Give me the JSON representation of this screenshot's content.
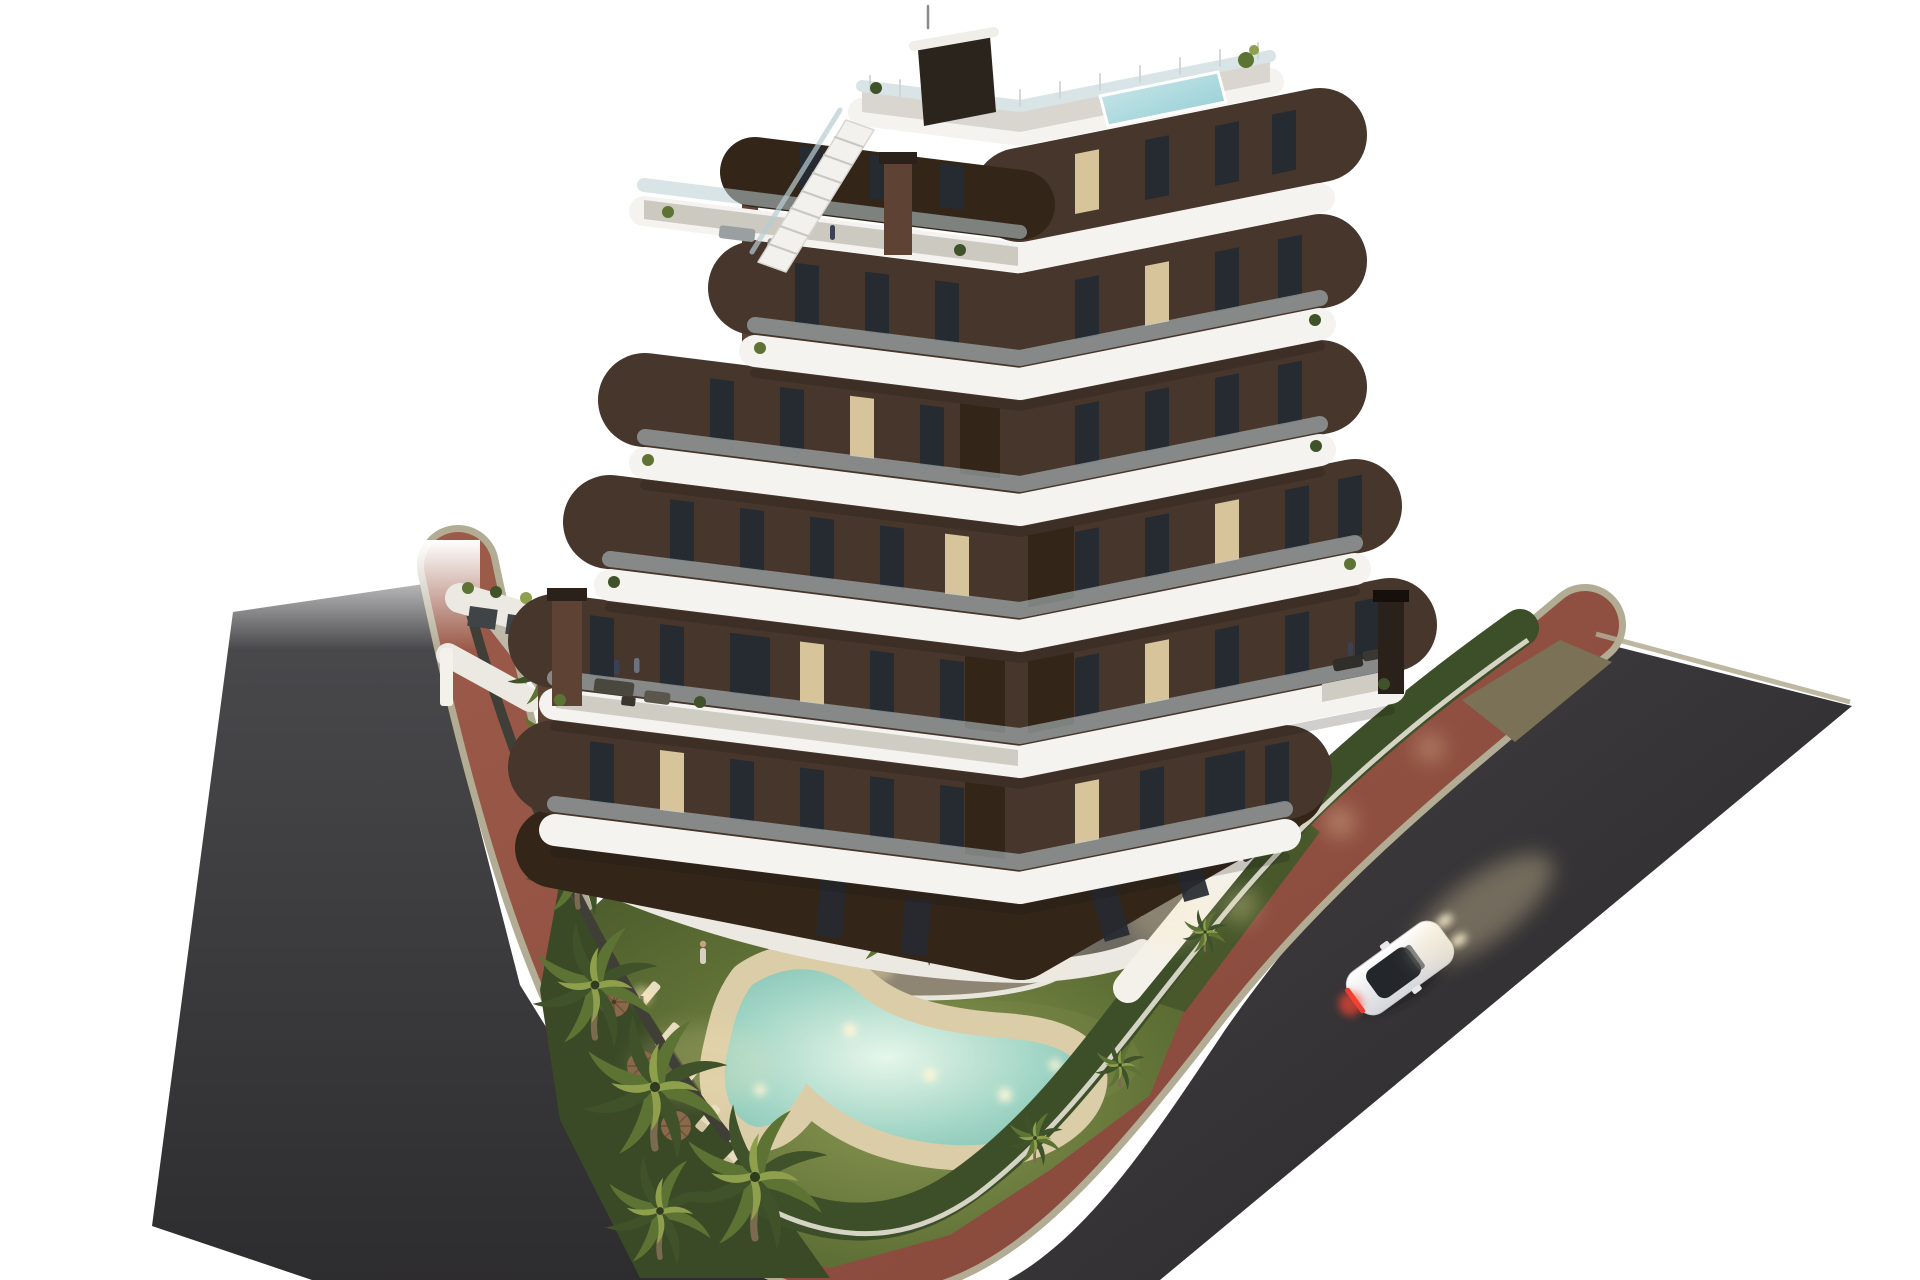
{
  "scene": {
    "description": "Aerial dusk 3D architectural rendering of a modern seven-storey apartment building with a V-shaped footprint, stacked curved white balcony bands, dark brown facade, rooftop terrace with plunge pool and external stair, landscaped private garden with a free-form swimming pool, sun loungers and parasols, palm trees, white perimeter walls and hedges, a red paved sidewalk wrapping the corner plot, dark asphalt streets and a single white car driving past with tail lights on.",
    "time_of_day": "dusk",
    "background": "white",
    "counts": {
      "building_floors_visible": 7,
      "rooftop_pools": 1,
      "garden_pools": 1,
      "parasols": 3,
      "sun_loungers": 7,
      "large_palm_trees": 8,
      "cars": 1,
      "chimneys": 3
    },
    "objects": [
      "apartment-building",
      "rooftop-pool",
      "roof-stairs",
      "penthouse-terrace",
      "balcony-bands",
      "big-terraces",
      "garden-lawn",
      "free-form-pool",
      "pool-lights",
      "sun-loungers",
      "parasols",
      "palm-trees",
      "hedges",
      "white-garden-walls",
      "red-sidewalk",
      "asphalt-streets",
      "white-car"
    ]
  },
  "palette": {
    "bg": "#ffffff",
    "asphalt_light": "#4b4b4e",
    "asphalt_dark": "#2d2c2e",
    "asphalt_r1": "#454245",
    "asphalt_r2": "#262527",
    "sidewalk_red": "#9c5a49",
    "sidewalk_red_dark": "#84463a",
    "curb": "#b3ac94",
    "concrete_light": "#c2bcad",
    "concrete_dark": "#989284",
    "court_gray": "#57534b",
    "terrace_gray": "#6e6a61",
    "lawn_light": "#8a9852",
    "lawn_mid": "#5f7036",
    "lawn_dark": "#48582a",
    "underplant": "#3a4a26",
    "hedge": "#3d4f28",
    "palm_dark": "#3f5229",
    "palm_mid": "#5c7334",
    "palm_light": "#8fa04c",
    "trunk": "#7a6a50",
    "island_gravel": "#8e8672",
    "pool_deck": "#dbcda7",
    "water_light": "#e6f6ea",
    "water_mid": "#9fd4c4",
    "water_deep": "#7cbcae",
    "roof_water1": "#cfeaec",
    "roof_water2": "#8fcbd2",
    "slab_white": "#f4f3f0",
    "slab_shadow": "#d9d7d1",
    "wall_white": "#ece9e3",
    "wall_bright": "#f4f1ea",
    "facade_brown": "#47362b",
    "facade_brown_dark": "#332619",
    "brick_side": "#5e4334",
    "chimney_dark": "#2a211a",
    "window_dark": "#262a31",
    "window_lit": "#d8c49a",
    "glass_rail": "#b9cdd4",
    "floor_strip": "#cfccc3",
    "car_body": "#eceded",
    "car_glass": "#23262b",
    "taillight": "#e23a2e",
    "glow_warm": "#ffe9b4",
    "people_navy": "#3a4152",
    "people_light": "#d8cfc0",
    "dirt_olive": "#7b7157",
    "umbrella": "#8a684a",
    "lounger": "#e8ddc0"
  }
}
